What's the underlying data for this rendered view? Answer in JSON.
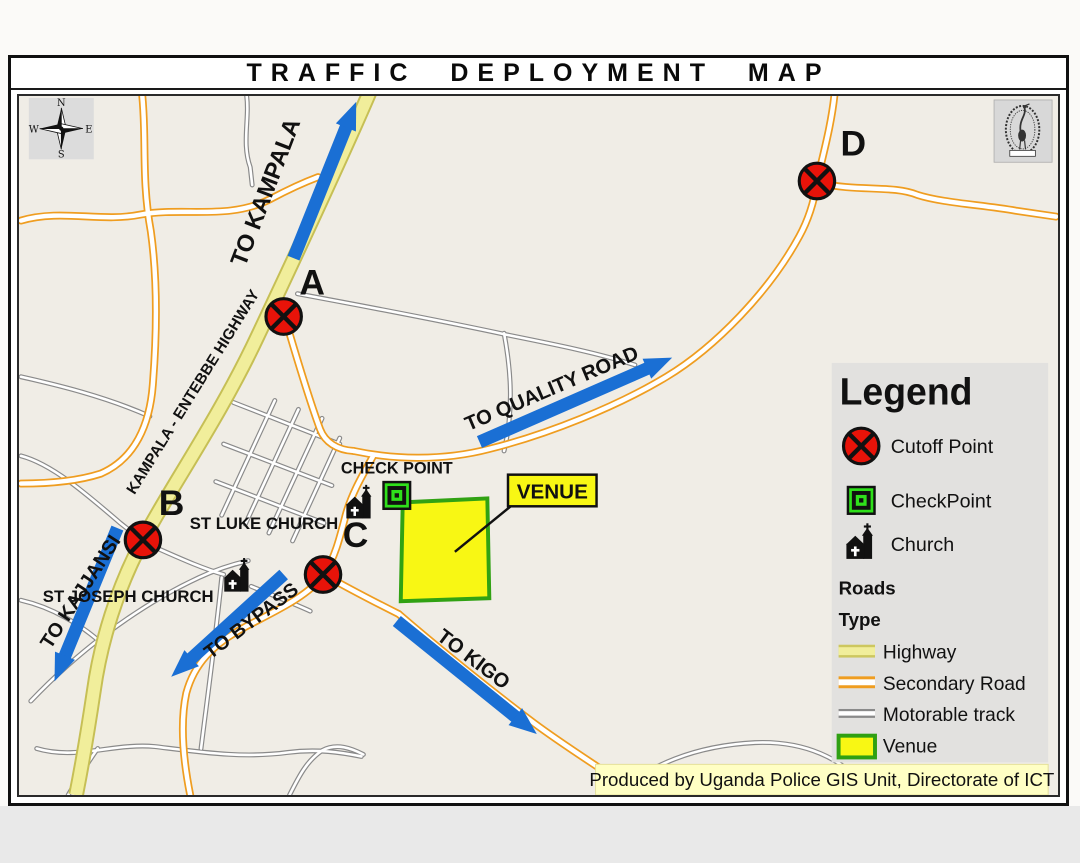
{
  "title": "TRAFFIC DEPLOYMENT MAP",
  "attribution": "Produced by Uganda Police GIS Unit, Directorate of ICT",
  "compass": {
    "n": "N",
    "e": "E",
    "s": "S",
    "w": "W"
  },
  "legend": {
    "title": "Legend",
    "items": [
      {
        "icon": "cutoff-point-icon",
        "label": "Cutoff Point"
      },
      {
        "icon": "checkpoint-icon",
        "label": "CheckPoint"
      },
      {
        "icon": "church-icon",
        "label": "Church"
      }
    ],
    "roads_header": "Roads",
    "type_header": "Type",
    "road_types": [
      {
        "swatch": "highway-swatch",
        "label": "Highway"
      },
      {
        "swatch": "secondary-road-swatch",
        "label": "Secondary Road"
      },
      {
        "swatch": "motorable-track-swatch",
        "label": "Motorable track"
      },
      {
        "swatch": "venue-swatch",
        "label": "Venue"
      }
    ]
  },
  "map": {
    "highway_name": "KAMPALA - ENTEBBE HIGHWAY",
    "direction_labels": {
      "kampala": "TO KAMPALA",
      "kajjansi": "TO KAJJANSI",
      "bypass": "TO BYPASS",
      "quality": "TO QUALITY ROAD",
      "kigo": "TO KIGO"
    },
    "cutoffs": [
      {
        "label": "A"
      },
      {
        "label": "B"
      },
      {
        "label": "C"
      },
      {
        "label": "D"
      }
    ],
    "check_point_label": "CHECK POINT",
    "venue_label": "VENUE",
    "churches": [
      {
        "label": "ST LUKE CHURCH"
      },
      {
        "label": "ST JOSEPH CHURCH"
      }
    ]
  },
  "colors": {
    "map_background": "#f0ede6",
    "highway_fill": "#f1ee9b",
    "highway_casing": "#c6bf55",
    "secondary_road_casing": "#ef9d20",
    "motorable_track_casing": "#8a8a8a",
    "arrow_blue": "#1a6fd4",
    "cutoff_red": "#e81309",
    "checkpoint_green": "#2fe01b",
    "venue_yellow": "#f8f714",
    "venue_border_green": "#31a213",
    "legend_background": "#e2e1df",
    "attribution_background": "#ffffc4"
  }
}
